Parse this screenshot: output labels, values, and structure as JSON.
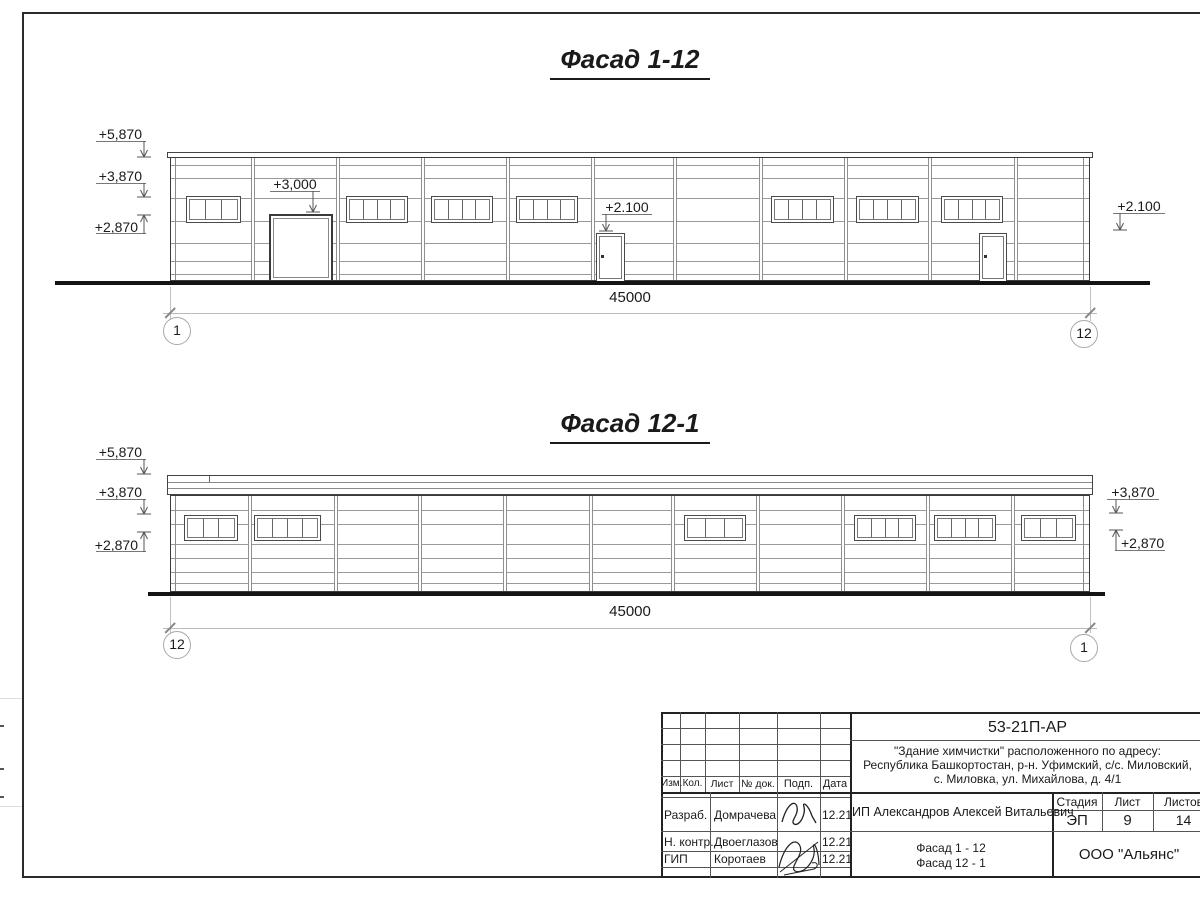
{
  "colors": {
    "ink": "#1a1a1a",
    "line_light": "#9a9a9a",
    "dim_line": "#bbbbbb"
  },
  "facade_top": {
    "title": "Фасад 1-12",
    "dimension": "45000",
    "axis_left": "1",
    "axis_right": "12",
    "marks": {
      "left": [
        "+5,870",
        "+3,870",
        "+2,870"
      ],
      "gate": "+3,000",
      "door_mid": "+2.100",
      "right": "+2.100"
    }
  },
  "facade_bottom": {
    "title": "Фасад 12-1",
    "dimension": "45000",
    "axis_left": "12",
    "axis_right": "1",
    "marks": {
      "left": [
        "+5,870",
        "+3,870",
        "+2,870"
      ],
      "right": [
        "+3,870",
        "+2,870"
      ]
    }
  },
  "titleblock": {
    "doc_number": "53-21П-АР",
    "project": [
      "\"Здание химчистки\" расположенного по адресу:",
      "Республика Башкортостан, р-н. Уфимский, с/с. Миловский,",
      "с. Миловка, ул. Михайлова, д. 4/1"
    ],
    "header_cols": [
      "Изм.",
      "Кол.",
      "Лист",
      "№ док.",
      "Подп.",
      "Дата"
    ],
    "client": "ИП Александров Алексей Витальевич",
    "signers": [
      {
        "role": "Разраб.",
        "name": "Домрачева",
        "date": "12.21"
      },
      {
        "role": "Н. контр.",
        "name": "Двоеглазов",
        "date": "12.21"
      },
      {
        "role": "ГИП",
        "name": "Коротаев",
        "date": "12.21"
      }
    ],
    "stage": {
      "label": "Стадия",
      "value": "ЭП"
    },
    "sheet": {
      "label": "Лист",
      "value": "9"
    },
    "sheets": {
      "label": "Листов",
      "value": "14"
    },
    "content": [
      "Фасад 1 - 12",
      "Фасад 12 - 1"
    ],
    "company": "ООО \"Альянс\""
  }
}
